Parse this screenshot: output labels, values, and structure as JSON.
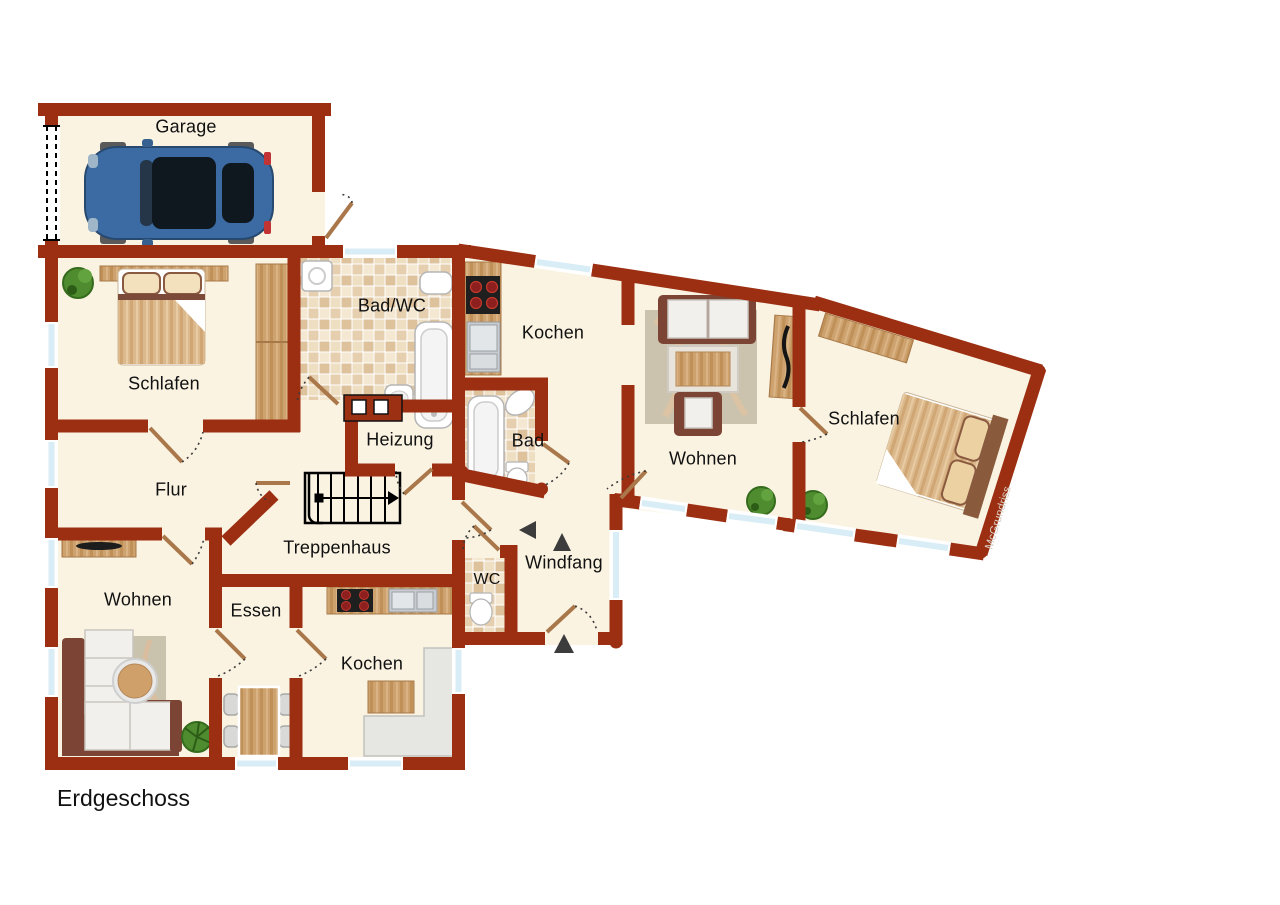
{
  "floorplan": {
    "title": "Erdgeschoss",
    "watermark": "McGrundriss",
    "rooms": {
      "garage": "Garage",
      "schlafen_left": "Schlafen",
      "bad_wc": "Bad/WC",
      "kochen_top": "Kochen",
      "heizung": "Heizung",
      "flur": "Flur",
      "treppenhaus": "Treppenhaus",
      "bad": "Bad",
      "wohnen_right": "Wohnen",
      "schlafen_right": "Schlafen",
      "wc": "WC",
      "windfang": "Windfang",
      "wohnen_left": "Wohnen",
      "essen": "Essen",
      "kochen_bottom": "Kochen"
    },
    "colors": {
      "wall": "#9c2f12",
      "floor": "#faf3e2",
      "tile_light": "#f1e3cb",
      "tile_dark": "#dec29c",
      "window_glass": "#d8edf5",
      "wood": "#cda26e",
      "door_leaf": "#a9774a",
      "plant": "#4f8c2f",
      "car_body": "#3c6ba3",
      "sofa_frame": "#7b4434"
    }
  }
}
